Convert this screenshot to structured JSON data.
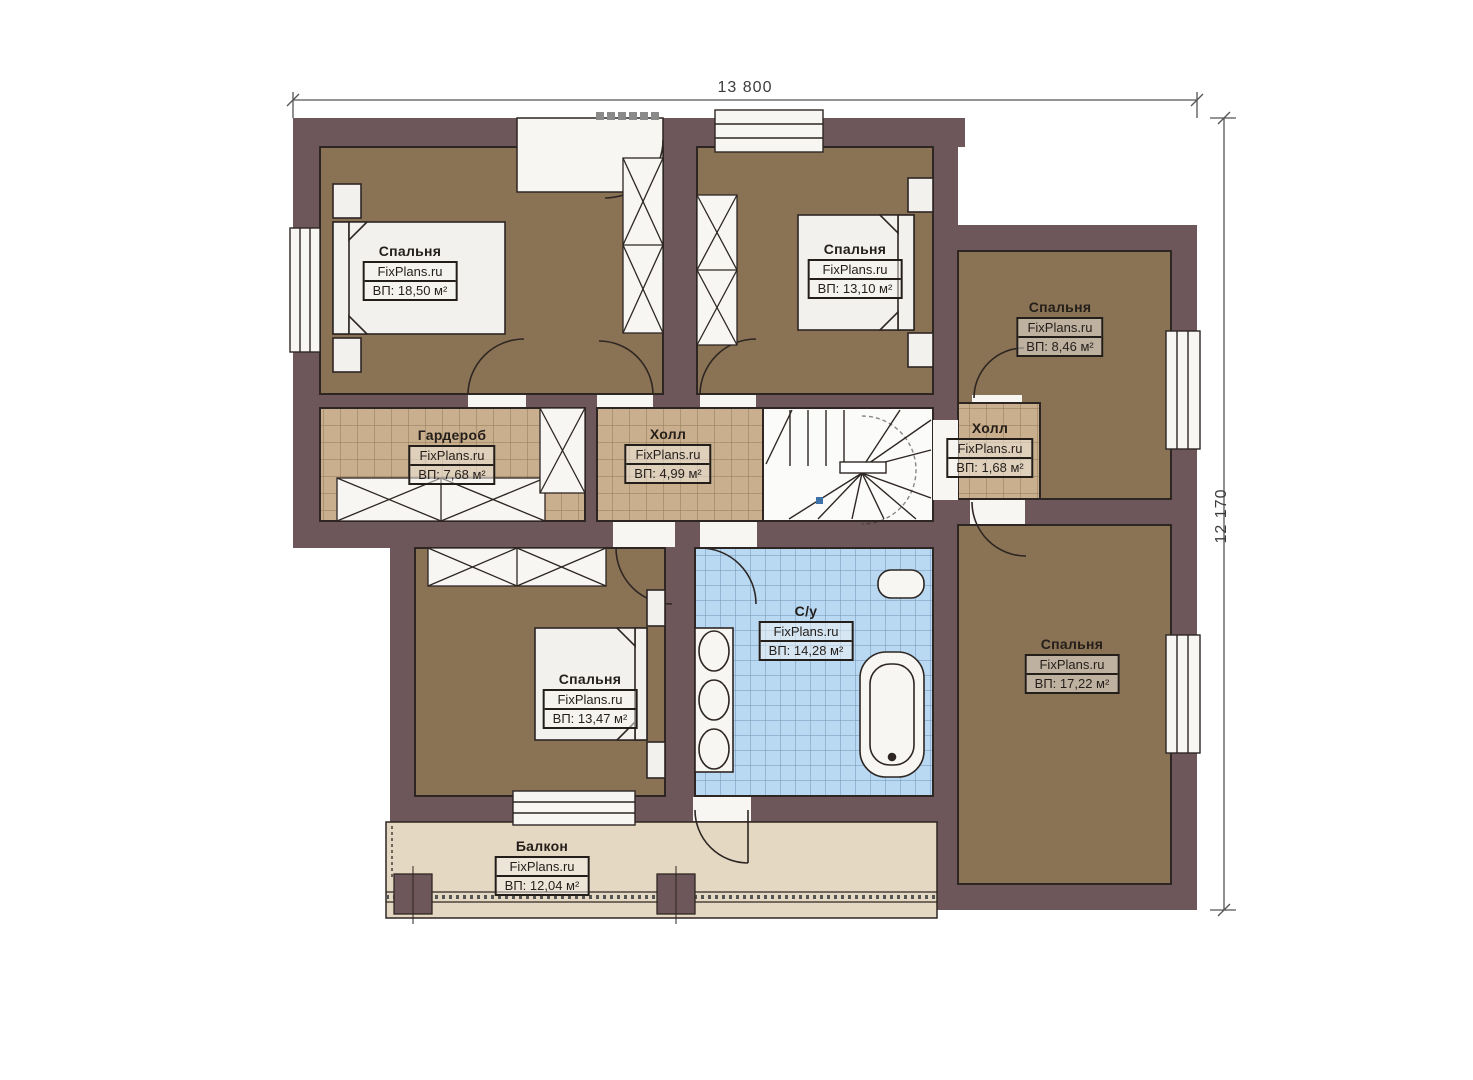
{
  "dimensions": {
    "width_label": "13 800",
    "height_label": "12 170"
  },
  "branding": "FixPlans.ru",
  "rooms": {
    "bedroom_top_left": {
      "name": "Спальня",
      "site": "FixPlans.ru",
      "area": "ВП: 18,50 м²"
    },
    "bedroom_top_middle": {
      "name": "Спальня",
      "site": "FixPlans.ru",
      "area": "ВП: 13,10 м²"
    },
    "bedroom_top_right": {
      "name": "Спальня",
      "site": "FixPlans.ru",
      "area": "ВП: 8,46 м²"
    },
    "wardrobe": {
      "name": "Гардероб",
      "site": "FixPlans.ru",
      "area": "ВП: 7,68 м²"
    },
    "hall": {
      "name": "Холл",
      "site": "FixPlans.ru",
      "area": "ВП: 4,99 м²"
    },
    "hall_small": {
      "name": "Холл",
      "site": "FixPlans.ru",
      "area": "ВП: 1,68 м²"
    },
    "bathroom": {
      "name": "С/у",
      "site": "FixPlans.ru",
      "area": "ВП: 14,28 м²"
    },
    "bedroom_bottom": {
      "name": "Спальня",
      "site": "FixPlans.ru",
      "area": "ВП: 13,47 м²"
    },
    "bedroom_right": {
      "name": "Спальня",
      "site": "FixPlans.ru",
      "area": "ВП: 17,22 м²"
    },
    "balcony": {
      "name": "Балкон",
      "site": "FixPlans.ru",
      "area": "ВП: 12,04 м²"
    }
  },
  "colors": {
    "wall": "#6d575a",
    "bedroom_floor": "#8a7355",
    "tile_tan": "#c9af8d",
    "tile_blue": "#b9d9f3",
    "balcony_floor": "#e4d8c2",
    "outline": "#2e2623",
    "fixture_white": "#f7f6f3",
    "section_marker": "#3f72a8"
  }
}
